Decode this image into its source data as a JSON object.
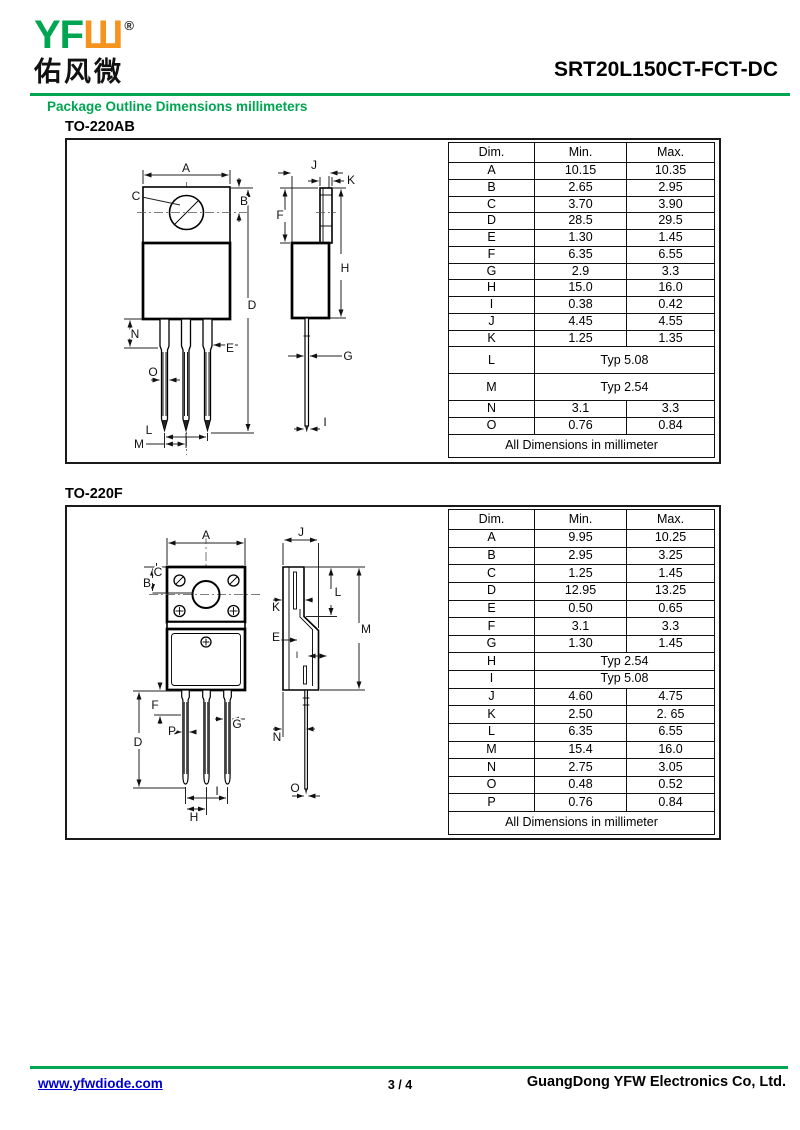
{
  "colors": {
    "green": "#00A551",
    "orange": "#F6921E",
    "link_blue": "#0000CE"
  },
  "header": {
    "logo_latin": "YF",
    "logo_glyph": "Ш",
    "registered_mark": "®",
    "logo_chinese": "佑风微",
    "part_number": "SRT20L150CT-FCT-DC",
    "subtitle": "Package Outline Dimensions millimeters"
  },
  "sections": [
    {
      "name": "TO-220AB",
      "table": {
        "headers": [
          "Dim.",
          "Min.",
          "Max."
        ],
        "rows": [
          {
            "d": "A",
            "min": "10.15",
            "max": "10.35"
          },
          {
            "d": "B",
            "min": "2.65",
            "max": "2.95"
          },
          {
            "d": "C",
            "min": "3.70",
            "max": "3.90"
          },
          {
            "d": "D",
            "min": "28.5",
            "max": "29.5"
          },
          {
            "d": "E",
            "min": "1.30",
            "max": "1.45"
          },
          {
            "d": "F",
            "min": "6.35",
            "max": "6.55"
          },
          {
            "d": "G",
            "min": "2.9",
            "max": "3.3"
          },
          {
            "d": "H",
            "min": "15.0",
            "max": "16.0"
          },
          {
            "d": "I",
            "min": "0.38",
            "max": "0.42"
          },
          {
            "d": "J",
            "min": "4.45",
            "max": "4.55"
          },
          {
            "d": "K",
            "min": "1.25",
            "max": "1.35"
          },
          {
            "d": "L",
            "span": "Typ 5.08",
            "tall": true
          },
          {
            "d": "M",
            "span": "Typ 2.54",
            "tall": true
          },
          {
            "d": "N",
            "min": "3.1",
            "max": "3.3"
          },
          {
            "d": "O",
            "min": "0.76",
            "max": "0.84"
          }
        ],
        "footer": "All Dimensions in millimeter"
      },
      "labels": [
        {
          "t": "A",
          "x": 189,
          "y": 176
        },
        {
          "t": "C",
          "x": 139,
          "y": 204
        },
        {
          "t": "B",
          "x": 247,
          "y": 209
        },
        {
          "t": "D",
          "x": 255,
          "y": 313
        },
        {
          "t": "N",
          "x": 138,
          "y": 342
        },
        {
          "t": "E",
          "x": 233,
          "y": 356
        },
        {
          "t": "O",
          "x": 156,
          "y": 380
        },
        {
          "t": "L",
          "x": 152,
          "y": 438
        },
        {
          "t": "M",
          "x": 142,
          "y": 452
        },
        {
          "t": "J",
          "x": 317,
          "y": 173
        },
        {
          "t": "K",
          "x": 354,
          "y": 188
        },
        {
          "t": "F",
          "x": 283,
          "y": 223
        },
        {
          "t": "H",
          "x": 348,
          "y": 276
        },
        {
          "t": "G",
          "x": 351,
          "y": 364
        },
        {
          "t": "I",
          "x": 328,
          "y": 430
        }
      ]
    },
    {
      "name": "TO-220F",
      "table": {
        "headers": [
          "Dim.",
          "Min.",
          "Max."
        ],
        "rows": [
          {
            "d": "A",
            "min": "9.95",
            "max": "10.25"
          },
          {
            "d": "B",
            "min": "2.95",
            "max": "3.25"
          },
          {
            "d": "C",
            "min": "1.25",
            "max": "1.45"
          },
          {
            "d": "D",
            "min": "12.95",
            "max": "13.25"
          },
          {
            "d": "E",
            "min": "0.50",
            "max": "0.65"
          },
          {
            "d": "F",
            "min": "3.1",
            "max": "3.3"
          },
          {
            "d": "G",
            "min": "1.30",
            "max": "1.45"
          },
          {
            "d": "H",
            "span": "Typ 2.54"
          },
          {
            "d": "I",
            "span": "Typ 5.08"
          },
          {
            "d": "J",
            "min": "4.60",
            "max": "4.75"
          },
          {
            "d": "K",
            "min": "2.50",
            "max": "2. 65"
          },
          {
            "d": "L",
            "min": "6.35",
            "max": "6.55"
          },
          {
            "d": "M",
            "min": "15.4",
            "max": "16.0"
          },
          {
            "d": "N",
            "min": "2.75",
            "max": "3.05"
          },
          {
            "d": "O",
            "min": "0.48",
            "max": "0.52"
          },
          {
            "d": "P",
            "min": "0.76",
            "max": "0.84"
          }
        ],
        "footer": "All Dimensions in millimeter"
      },
      "labels": [
        {
          "t": "A",
          "x": 209,
          "y": 544
        },
        {
          "t": "C",
          "x": 161,
          "y": 581
        },
        {
          "t": "B",
          "x": 150,
          "y": 592
        },
        {
          "t": "F",
          "x": 158,
          "y": 714
        },
        {
          "t": "P",
          "x": 175,
          "y": 740
        },
        {
          "t": "D",
          "x": 141,
          "y": 751
        },
        {
          "t": "G",
          "x": 240,
          "y": 733
        },
        {
          "t": "I",
          "x": 220,
          "y": 800
        },
        {
          "t": "H",
          "x": 197,
          "y": 826
        },
        {
          "t": "J",
          "x": 304,
          "y": 541
        },
        {
          "t": "K",
          "x": 279,
          "y": 616
        },
        {
          "t": "L",
          "x": 341,
          "y": 601
        },
        {
          "t": "M",
          "x": 369,
          "y": 638
        },
        {
          "t": "E",
          "x": 279,
          "y": 646
        },
        {
          "t": "I",
          "x": 300,
          "y": 663,
          "small": true
        },
        {
          "t": "N",
          "x": 280,
          "y": 746
        },
        {
          "t": "O",
          "x": 298,
          "y": 797
        }
      ]
    }
  ],
  "footer": {
    "website": "www.yfwdiode.com",
    "page": "3 / 4",
    "company": "GuangDong YFW Electronics Co, Ltd."
  }
}
